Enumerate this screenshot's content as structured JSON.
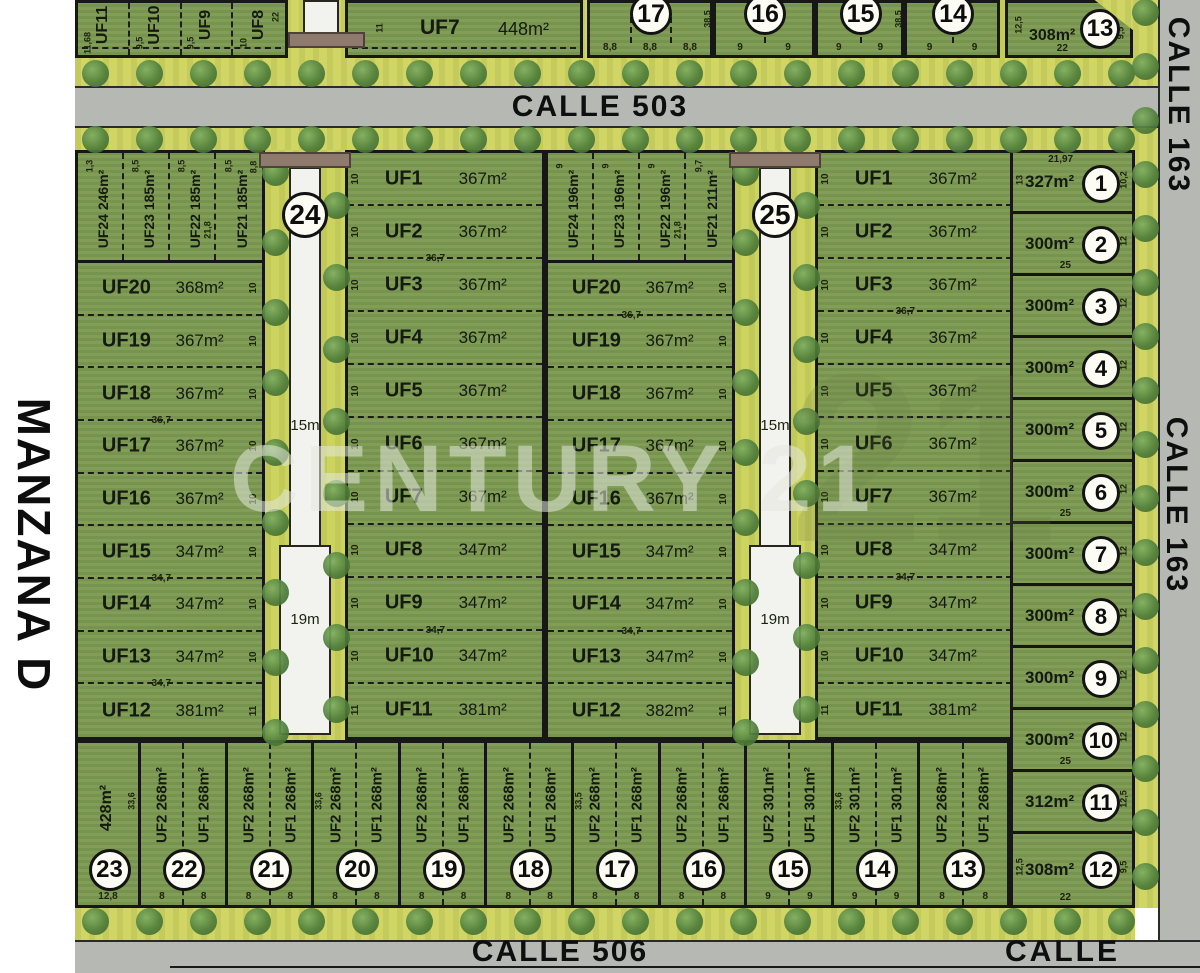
{
  "margin_label": "MANZANA D",
  "watermark": {
    "text": "CENTURY 21",
    "big_number": "21"
  },
  "streets": {
    "top": "CALLE 503",
    "bottom": "CALLE 506",
    "right_top": "CALLE 163",
    "right_mid": "CALLE 163",
    "bottom_right": "CALLE"
  },
  "colors": {
    "lot_green": "#7d9a52",
    "verge_yellow": "#d0d563",
    "street_gray": "#b6b9b3",
    "path_white": "#f2f2ee",
    "bridge_brown": "#8e7b6e",
    "line_black": "#171717"
  },
  "top_strip": {
    "left_lots": [
      {
        "label": "UF11",
        "dim": "11,68"
      },
      {
        "label": "UF10",
        "dim": "9,5"
      },
      {
        "label": "UF9",
        "dim": "9,5"
      },
      {
        "label": "UF8",
        "dim": "10"
      }
    ],
    "right_edge_dim": "22",
    "uf7": {
      "label": "UF7",
      "area": "448m²",
      "side_dim": "11"
    },
    "numbered_lots": [
      {
        "num": "17",
        "bottom_dims": [
          "8,8",
          "8,8",
          "8,8"
        ],
        "side_dim": "38,5"
      },
      {
        "num": "16",
        "bottom_dims": [
          "9",
          "9"
        ]
      },
      {
        "num": "15",
        "bottom_dims": [
          "9",
          "9"
        ],
        "side_dim": "38,5"
      },
      {
        "num": "14",
        "bottom_dims": [
          "9",
          "9"
        ]
      }
    ],
    "corner_lot": {
      "num": "13",
      "area": "308m²",
      "left_dim": "12,5",
      "right_dim": "9,5",
      "bottom_dim": "22"
    }
  },
  "block24": {
    "circle": "24",
    "path_top": "15m",
    "path_bottom": "19m",
    "top_corner_dim": "8,8",
    "top_lots": [
      {
        "label": "UF24",
        "area": "246m²",
        "top_dim": "1,3"
      },
      {
        "label": "UF23",
        "area": "185m²",
        "top_dim": "8,5"
      },
      {
        "label": "UF22",
        "area": "185m²",
        "top_dim": "8,5",
        "side_dim": "21,8"
      },
      {
        "label": "UF21",
        "area": "185m²",
        "top_dim": "8,5"
      }
    ],
    "left_lots": [
      {
        "label": "UF20",
        "area": "368m²",
        "side_dim": "10"
      },
      {
        "label": "UF19",
        "area": "367m²",
        "side_dim": "10"
      },
      {
        "label": "UF18",
        "area": "367m²",
        "side_dim": "10",
        "under_dim": "36,7"
      },
      {
        "label": "UF17",
        "area": "367m²",
        "side_dim": "10"
      },
      {
        "label": "UF16",
        "area": "367m²",
        "side_dim": "10"
      },
      {
        "label": "UF15",
        "area": "347m²",
        "side_dim": "10",
        "under_dim": "34,7"
      },
      {
        "label": "UF14",
        "area": "347m²",
        "side_dim": "10"
      },
      {
        "label": "UF13",
        "area": "347m²",
        "side_dim": "10",
        "under_dim": "34,7"
      },
      {
        "label": "UF12",
        "area": "381m²",
        "side_dim": "11"
      }
    ],
    "right_lots": [
      {
        "label": "UF1",
        "area": "367m²",
        "side_dim": "10"
      },
      {
        "label": "UF2",
        "area": "367m²",
        "side_dim": "10",
        "under_dim": "36,7"
      },
      {
        "label": "UF3",
        "area": "367m²",
        "side_dim": "10"
      },
      {
        "label": "UF4",
        "area": "367m²",
        "side_dim": "10"
      },
      {
        "label": "UF5",
        "area": "367m²",
        "side_dim": "10"
      },
      {
        "label": "UF6",
        "area": "367m²",
        "side_dim": "10"
      },
      {
        "label": "UF7",
        "area": "367m²",
        "side_dim": "10"
      },
      {
        "label": "UF8",
        "area": "347m²",
        "side_dim": "10"
      },
      {
        "label": "UF9",
        "area": "347m²",
        "side_dim": "10",
        "under_dim": "34,7"
      },
      {
        "label": "UF10",
        "area": "347m²",
        "side_dim": "10"
      },
      {
        "label": "UF11",
        "area": "381m²",
        "side_dim": "11"
      }
    ]
  },
  "block25": {
    "circle": "25",
    "path_top": "15m",
    "path_bottom": "19m",
    "top_lots": [
      {
        "label": "UF24",
        "area": "196m²",
        "top_dim": "9"
      },
      {
        "label": "UF23",
        "area": "196m²",
        "top_dim": "9"
      },
      {
        "label": "UF22",
        "area": "196m²",
        "top_dim": "9",
        "side_dim": "21,8"
      },
      {
        "label": "UF21",
        "area": "211m²",
        "top_dim": "9,7"
      }
    ],
    "left_lots": [
      {
        "label": "UF20",
        "area": "367m²",
        "side_dim": "10",
        "under_dim": "36,7"
      },
      {
        "label": "UF19",
        "area": "367m²",
        "side_dim": "10"
      },
      {
        "label": "UF18",
        "area": "367m²",
        "side_dim": "10"
      },
      {
        "label": "UF17",
        "area": "367m²",
        "side_dim": "10"
      },
      {
        "label": "UF16",
        "area": "367m²",
        "side_dim": "10"
      },
      {
        "label": "UF15",
        "area": "347m²",
        "side_dim": "10"
      },
      {
        "label": "UF14",
        "area": "347m²",
        "side_dim": "10",
        "under_dim": "34,7"
      },
      {
        "label": "UF13",
        "area": "347m²",
        "side_dim": "10"
      },
      {
        "label": "UF12",
        "area": "382m²",
        "side_dim": "11"
      }
    ],
    "right_lots": [
      {
        "label": "UF1",
        "area": "367m²",
        "side_dim": "10"
      },
      {
        "label": "UF2",
        "area": "367m²",
        "side_dim": "10"
      },
      {
        "label": "UF3",
        "area": "367m²",
        "side_dim": "10",
        "under_dim": "36,7"
      },
      {
        "label": "UF4",
        "area": "367m²",
        "side_dim": "10"
      },
      {
        "label": "UF5",
        "area": "367m²",
        "side_dim": "10"
      },
      {
        "label": "UF6",
        "area": "367m²",
        "side_dim": "10"
      },
      {
        "label": "UF7",
        "area": "367m²",
        "side_dim": "10"
      },
      {
        "label": "UF8",
        "area": "347m²",
        "side_dim": "10",
        "under_dim": "34,7"
      },
      {
        "label": "UF9",
        "area": "347m²",
        "side_dim": "10"
      },
      {
        "label": "UF10",
        "area": "347m²",
        "side_dim": "10"
      },
      {
        "label": "UF11",
        "area": "381m²",
        "side_dim": "11"
      }
    ]
  },
  "bottom_row": [
    {
      "num": "23",
      "single_area": "428m²",
      "bottom_dims": [
        "12,8"
      ],
      "depth_dim": "33,6",
      "depth_side": "right"
    },
    {
      "num": "22",
      "uf2": {
        "label": "UF2",
        "area": "268m²"
      },
      "uf1": {
        "label": "UF1",
        "area": "268m²"
      },
      "bottom_dims": [
        "8",
        "8"
      ]
    },
    {
      "num": "21",
      "uf2": {
        "label": "UF2",
        "area": "268m²"
      },
      "uf1": {
        "label": "UF1",
        "area": "268m²"
      },
      "bottom_dims": [
        "8",
        "8"
      ]
    },
    {
      "num": "20",
      "uf2": {
        "label": "UF2",
        "area": "268m²"
      },
      "uf1": {
        "label": "UF1",
        "area": "268m²"
      },
      "bottom_dims": [
        "8",
        "8"
      ],
      "depth_dim": "33,6",
      "depth_side": "left"
    },
    {
      "num": "19",
      "uf2": {
        "label": "UF2",
        "area": "268m²"
      },
      "uf1": {
        "label": "UF1",
        "area": "268m²"
      },
      "bottom_dims": [
        "8",
        "8"
      ]
    },
    {
      "num": "18",
      "uf2": {
        "label": "UF2",
        "area": "268m²"
      },
      "uf1": {
        "label": "UF1",
        "area": "268m²"
      },
      "bottom_dims": [
        "8",
        "8"
      ]
    },
    {
      "num": "17",
      "uf2": {
        "label": "UF2",
        "area": "268m²"
      },
      "uf1": {
        "label": "UF1",
        "area": "268m²"
      },
      "bottom_dims": [
        "8",
        "8"
      ],
      "depth_dim": "33,5",
      "depth_side": "left"
    },
    {
      "num": "16",
      "uf2": {
        "label": "UF2",
        "area": "268m²"
      },
      "uf1": {
        "label": "UF1",
        "area": "268m²"
      },
      "bottom_dims": [
        "8",
        "8"
      ]
    },
    {
      "num": "15",
      "uf2": {
        "label": "UF2",
        "area": "301m²"
      },
      "uf1": {
        "label": "UF1",
        "area": "301m²"
      },
      "bottom_dims": [
        "9",
        "9"
      ]
    },
    {
      "num": "14",
      "uf2": {
        "label": "UF2",
        "area": "301m²"
      },
      "uf1": {
        "label": "UF1",
        "area": "301m²"
      },
      "bottom_dims": [
        "9",
        "9"
      ],
      "depth_dim": "33,6",
      "depth_side": "left"
    },
    {
      "num": "13",
      "uf2": {
        "label": "UF2",
        "area": "268m²"
      },
      "uf1": {
        "label": "UF1",
        "area": "268m²"
      },
      "bottom_dims": [
        "8",
        "8"
      ]
    }
  ],
  "right_column": [
    {
      "num": "1",
      "area": "327m²",
      "top_dim": "21,97",
      "left_dim": "13",
      "right_dim": "10,2"
    },
    {
      "num": "2",
      "area": "300m²",
      "right_dim": "12",
      "bottom_dim": "25"
    },
    {
      "num": "3",
      "area": "300m²",
      "right_dim": "12"
    },
    {
      "num": "4",
      "area": "300m²",
      "right_dim": "12"
    },
    {
      "num": "5",
      "area": "300m²",
      "right_dim": "12"
    },
    {
      "num": "6",
      "area": "300m²",
      "right_dim": "12",
      "bottom_dim": "25"
    },
    {
      "num": "7",
      "area": "300m²",
      "right_dim": "12"
    },
    {
      "num": "8",
      "area": "300m²",
      "right_dim": "12"
    },
    {
      "num": "9",
      "area": "300m²",
      "right_dim": "12"
    },
    {
      "num": "10",
      "area": "300m²",
      "right_dim": "12",
      "bottom_dim": "25"
    },
    {
      "num": "11",
      "area": "312m²",
      "right_dim": "12,5"
    },
    {
      "num": "12",
      "area": "308m²",
      "left_dim": "12,5",
      "right_dim": "9,5",
      "bottom_dim": "22"
    }
  ]
}
